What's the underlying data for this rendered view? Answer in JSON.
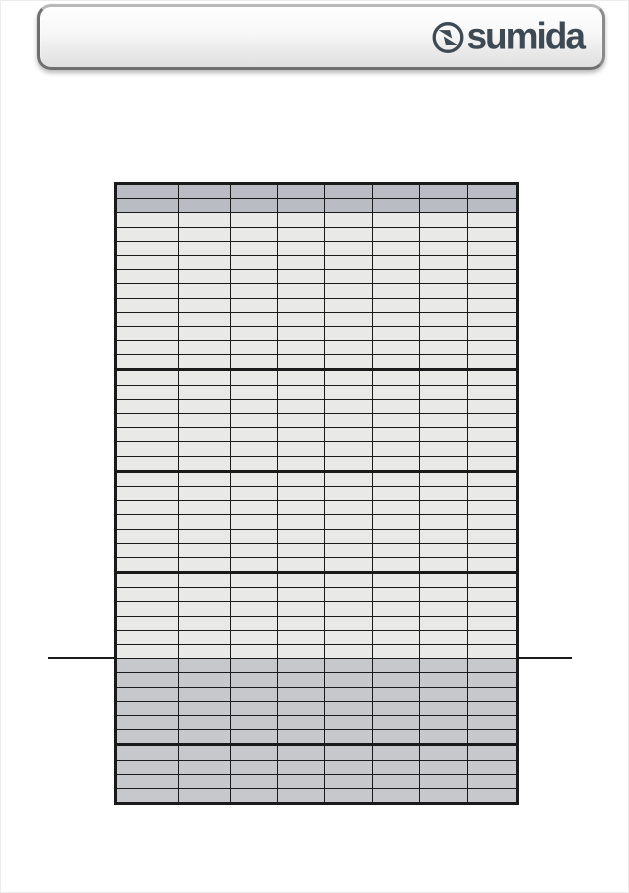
{
  "page": {
    "background_color": "#ffffff"
  },
  "header": {
    "logo_text": "sumida",
    "logo_color": "#3d4953",
    "logo_icon": "sumida-pinwheel-circle-icon",
    "bar_gradient_top": "#ffffff",
    "bar_gradient_bottom": "#e0e0e0",
    "bar_border_color": "#6f6f6f"
  },
  "divider_line": {
    "color": "#1a1a1a"
  },
  "table": {
    "columns": 8,
    "border_color": "#1a1a1a",
    "header_fill": "#b9bcc2",
    "light_fill": "#e9eae8",
    "dark_fill": "#c6c8cc",
    "cell_text": "",
    "sections": [
      {
        "name": "header-rows",
        "rows": 2,
        "shade": "header",
        "thick_bottom": false
      },
      {
        "name": "body-section-1",
        "rows": 11,
        "shade": "light",
        "thick_bottom": true
      },
      {
        "name": "body-section-2",
        "rows": 7,
        "shade": "light",
        "thick_bottom": true
      },
      {
        "name": "body-section-3",
        "rows": 7,
        "shade": "light",
        "thick_bottom": true
      },
      {
        "name": "body-section-4",
        "rows": 6,
        "shade": "light",
        "thick_bottom": false
      },
      {
        "name": "shaded-section-1",
        "rows": 6,
        "shade": "dark",
        "thick_bottom": true
      },
      {
        "name": "shaded-section-2",
        "rows": 4,
        "shade": "dark",
        "thick_bottom": false
      }
    ]
  }
}
